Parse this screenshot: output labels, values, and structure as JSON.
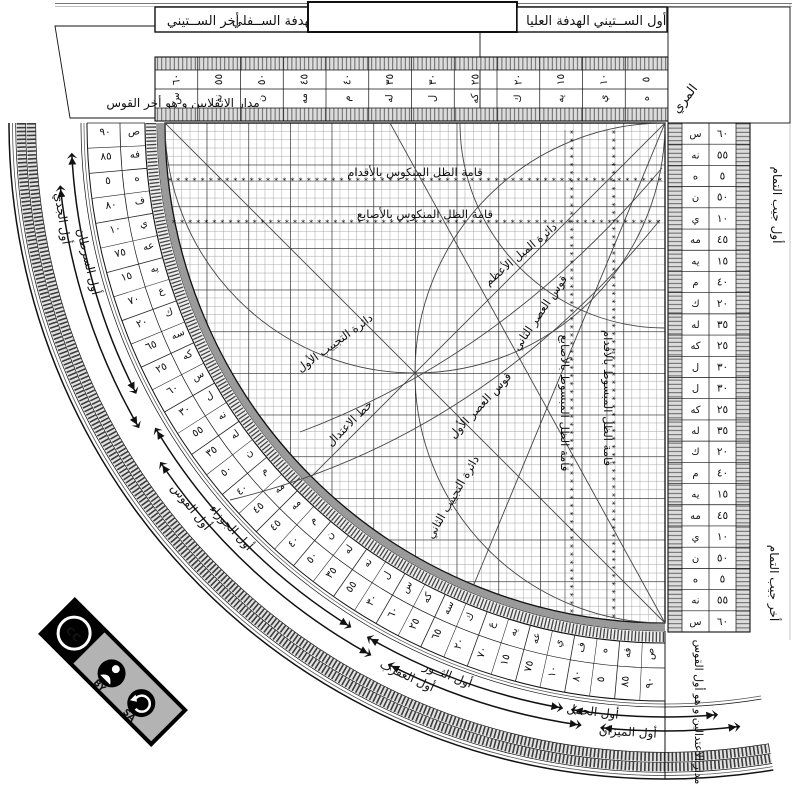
{
  "instrument": {
    "title": "Sine quadrant (rub al-mujayyab) diagram",
    "plates": {
      "left": {
        "labels": [
          "أخر الســتيني",
          "الهدفة الســفلي"
        ]
      },
      "right": {
        "labels": [
          "الهدفة العليا",
          "أول الســتيني"
        ]
      }
    },
    "corner_label": "المري",
    "top_left_label": "مدار الانقلابين و هو أخر القوس",
    "bottom_right_label": "مدار الاعتدالين و هو أول القوس",
    "right_edge": {
      "top_label": "أول جيب التمام",
      "bottom_label": "أخر جيب التمام"
    },
    "top_ruler": {
      "numerals": [
        "٥",
        "١٠",
        "١٥",
        "٢٠",
        "٢٥",
        "٣٠",
        "٣٥",
        "٤٠",
        "٤٥",
        "٥٠",
        "٥٥",
        "٦٠"
      ],
      "abjad": [
        "ه",
        "ي",
        "يه",
        "ك",
        "كه",
        "ل",
        "له",
        "م",
        "مه",
        "ن",
        "نه",
        "س"
      ]
    },
    "right_ruler": {
      "numerals": [
        "٦٠",
        "٥٥",
        "٥",
        "٥٠",
        "١٠",
        "٤٥",
        "١٥",
        "٤٠",
        "٢٠",
        "٣٥",
        "٢٥",
        "٣٠",
        "٣٠",
        "٢٥",
        "٣٥",
        "٢٠",
        "٤٠",
        "١٥",
        "٤٥",
        "١٠",
        "٥٠",
        "٥",
        "٥٥",
        "٦٠"
      ],
      "abjad": [
        "س",
        "نه",
        "ه",
        "ن",
        "ي",
        "مه",
        "يه",
        "م",
        "ك",
        "له",
        "كه",
        "ل",
        "ل",
        "كه",
        "له",
        "ك",
        "م",
        "يه",
        "مه",
        "ي",
        "ن",
        "ه",
        "نه",
        "س"
      ]
    },
    "degree_ring": {
      "numerals": [
        "٩٠",
        "٨٥",
        "٥",
        "٨٠",
        "١٠",
        "٧٥",
        "١٥",
        "٧٠",
        "٢٠",
        "٦٥",
        "٢٥",
        "٦٠",
        "٣٠",
        "٥٥",
        "٣٥",
        "٥٠",
        "٤٠",
        "٤٥",
        "٤٥",
        "٤٠",
        "٥٠",
        "٣٥",
        "٥٥",
        "٣٠",
        "٦٠",
        "٢٥",
        "٦٥",
        "٢٠",
        "٧٠",
        "١٥",
        "٧٥",
        "١٠",
        "٨٠",
        "٥",
        "٨٥",
        "٩٠"
      ],
      "abjad": [
        "ص",
        "فه",
        "ه",
        "ف",
        "ي",
        "عه",
        "يه",
        "ع",
        "ك",
        "سه",
        "كه",
        "س",
        "ل",
        "نه",
        "له",
        "ن",
        "م",
        "مه",
        "مه",
        "م",
        "ن",
        "له",
        "نه",
        "ل",
        "س",
        "كه",
        "سه",
        "ك",
        "ع",
        "يه",
        "عه",
        "ي",
        "ف",
        "ه",
        "فه",
        "ص"
      ]
    },
    "zodiac": [
      {
        "label": "أول الجدي",
        "r": 614,
        "a": 171
      },
      {
        "label": "أول السرطان",
        "r": 597,
        "a": 166.5
      },
      {
        "label": "أول القوس",
        "r": 614,
        "a": 141
      },
      {
        "label": "أول الجوزاء",
        "r": 597,
        "a": 137
      },
      {
        "label": "أول العقرب",
        "r": 614,
        "a": 115
      },
      {
        "label": "أول الثــور",
        "r": 597,
        "a": 111.5
      },
      {
        "label": "أول الميزان",
        "r": 614,
        "a": 93.5
      },
      {
        "label": "أول الحمل",
        "r": 597,
        "a": 97
      }
    ],
    "grid_labels": {
      "inverted_feet": "قامة الظل المنكوس بالأقدام",
      "inverted_digits": "قامة الظل المنكوس بالأصابع",
      "extended_digits": "قامة الظل المبسوط بالأصابع",
      "extended_feet": "قامة الظل المبسوط بالأقدام",
      "declination": "دائرة الميل الأعظم",
      "sine1": "دائرة التجييب الأول",
      "sine2": "دائرة التجييب الثاني",
      "asr1": "قوس العصر الأول",
      "asr2": "قوس العصر الثاني",
      "equinox": "خط الاعتدال"
    },
    "badge": {
      "cc_label": "cc",
      "by_label": "BY",
      "sa_label": "SA"
    }
  },
  "colors": {
    "ink": "#111111",
    "grid_minor": "#9b9b9b",
    "grid_major": "#222222",
    "dark_band": "#9a9a9a",
    "hatch_bg": "#dcdcdc",
    "badge_gray": "#b3b3b3"
  }
}
